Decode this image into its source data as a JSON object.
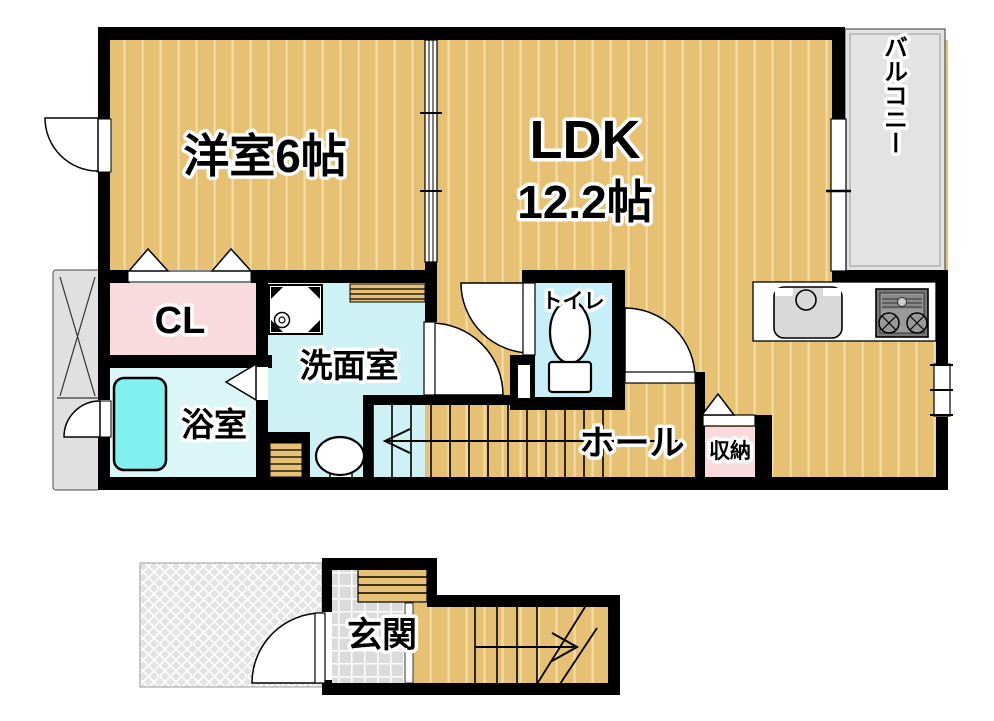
{
  "floor_plan": {
    "second_floor": {
      "western_room": {
        "label": "洋室6帖"
      },
      "ldk": {
        "label": "LDK",
        "size": "12.2帖"
      },
      "balcony": {
        "label": "バルコニー"
      },
      "closet": {
        "label": "CL"
      },
      "washroom": {
        "label": "洗面室"
      },
      "bathroom": {
        "label": "浴室"
      },
      "toilet": {
        "label": "トイレ"
      },
      "hall": {
        "label": "ホール"
      },
      "storage": {
        "label": "収納"
      }
    },
    "first_floor": {
      "entrance": {
        "label": "玄関"
      }
    },
    "colors": {
      "wall": "#000000",
      "flooring": "#e7c173",
      "closet_pink": "#f9dadd",
      "washroom_cyan": "#cdf1f5",
      "bathroom_cyan": "#daf6f7",
      "toilet_cyan": "#c6eff7",
      "bathtub_cyan": "#80f1ef",
      "balcony_gray": "#e3e3e3",
      "entrance_tile_gray": "#dbdbdb"
    }
  }
}
